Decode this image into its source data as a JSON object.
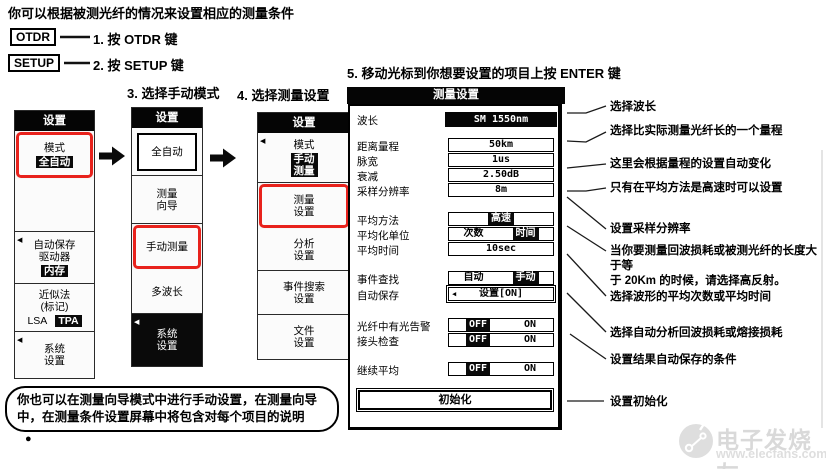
{
  "header": {
    "title": "你可以根据被测光纤的情况来设置相应的测量条件"
  },
  "steps": {
    "key1": "OTDR",
    "label1": "1. 按 OTDR 键",
    "key2": "SETUP",
    "label2": "2. 按 SETUP 键",
    "step3": "3. 选择手动模式",
    "step4": "4. 选择测量设置",
    "step5": "5. 移动光标到你想要设置的项目上按 ENTER 键"
  },
  "icons": {
    "submenu_marker": "◀",
    "bullet": "●",
    "flow_arrow": "right-arrow"
  },
  "colors": {
    "highlight_red": "#e8221c",
    "menu_black": "#050505",
    "watermark_gray": "#d9d9d9"
  },
  "menu1": {
    "title": "设置",
    "mode_label": "模式",
    "mode_value": "全自动",
    "autosave": "自动保存\n驱动器",
    "autosave_value": "内存",
    "approx": "近似法\n(标记)",
    "approx_lsa": "LSA",
    "approx_tpa": "TPA",
    "system": "系统\n设置"
  },
  "menu2": {
    "title": "设置",
    "item_auto": "全自动",
    "item_wizard": "测量\n向导",
    "item_manual": "手动测量",
    "item_multi": "多波长",
    "item_system": "系统\n设置"
  },
  "menu3": {
    "title": "设置",
    "mode_label": "模式",
    "mode_value": "手动\n测量",
    "item_measure": "测量\n设置",
    "item_analysis": "分析\n设置",
    "item_event": "事件搜索\n设置",
    "item_file": "文件\n设置"
  },
  "dialog": {
    "title": "测量设置",
    "rows": [
      {
        "label": "波长",
        "value": "SM 1550nm"
      },
      {
        "label": "距离量程",
        "value": "50km"
      },
      {
        "label": "脉宽",
        "value": "1us"
      },
      {
        "label": "衰减",
        "value": "2.50dB"
      },
      {
        "label": "采样分辨率",
        "value": "8m"
      },
      {
        "label": "平均方法",
        "value": "高速"
      },
      {
        "label": "平均化单位",
        "options": [
          "次数",
          "时间"
        ],
        "selected": "时间"
      },
      {
        "label": "平均时间",
        "value": "10sec"
      },
      {
        "label": "事件查找",
        "options": [
          "自动",
          "手动"
        ],
        "selected": "手动"
      },
      {
        "label": "自动保存",
        "value": "设置[ON]"
      },
      {
        "label": "光纤中有光告警",
        "options": [
          "OFF",
          "ON"
        ],
        "selected": "OFF"
      },
      {
        "label": "接头检查",
        "options": [
          "OFF",
          "ON"
        ],
        "selected": "OFF"
      },
      {
        "label": "继续平均",
        "options": [
          "OFF",
          "ON"
        ],
        "selected": "OFF"
      }
    ],
    "init_button": "初始化"
  },
  "annotations": [
    "选择波长",
    "选择比实际测量光纤长的一个量程",
    "这里会根据量程的设置自动变化",
    "只有在平均方法是高速时可以设置",
    "设置采样分辨率",
    "当你要测量回波损耗或被测光纤的长度大于等\n于 20Km 的时候，请选择高反射。",
    "选择波形的平均次数或平均时间",
    "选择自动分析回波损耗或熔接损耗",
    "设置结果自动保存的条件",
    "设置初始化"
  ],
  "note": "你也可以在测量向导模式中进行手动设置，在测量向导\n中，在测量条件设置屏幕中将包含对每个项目的说明",
  "watermark": {
    "brand": "电子发烧友",
    "site": "www.elecfans.com"
  }
}
